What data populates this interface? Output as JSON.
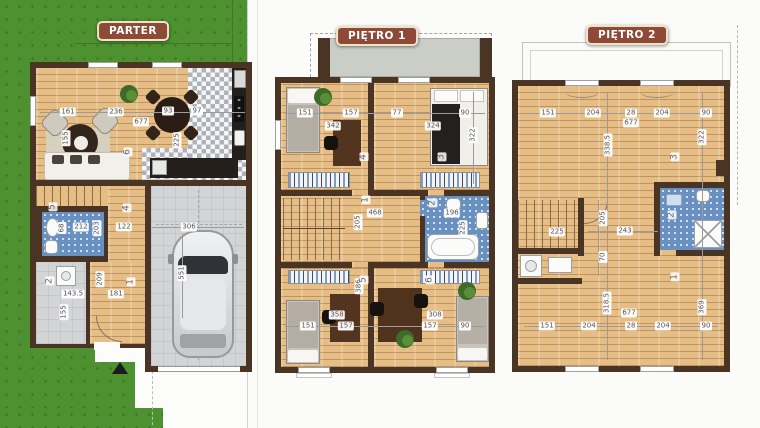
{
  "title": "Floor plans - PARTER / PIĘTRO 1 / PIĘTRO 2",
  "colors": {
    "badge_bg": "#8e4a36",
    "badge_border": "#efe3c6",
    "wall": "#4a3424",
    "wood": "#e5bd85",
    "bath_tile": "#6890c1",
    "garage_grey": "#d3d4d6",
    "lawn_green": "#4e9130",
    "terrace_grey": "#cbcdc7"
  },
  "plans": {
    "parter": {
      "label": "PARTER",
      "labels": [
        {
          "t": "161",
          "x": 68,
          "y": 112
        },
        {
          "t": "236",
          "x": 116,
          "y": 112
        },
        {
          "t": "93",
          "x": 168,
          "y": 111
        },
        {
          "t": "97",
          "x": 197,
          "y": 111
        },
        {
          "t": "677",
          "x": 141,
          "y": 122
        },
        {
          "t": "155",
          "x": 66,
          "y": 138,
          "v": true
        },
        {
          "t": "225",
          "x": 177,
          "y": 140,
          "v": true
        },
        {
          "t": "6",
          "x": 128,
          "y": 152,
          "v": true,
          "room": true
        },
        {
          "t": "4",
          "x": 127,
          "y": 208,
          "v": true,
          "room": true
        },
        {
          "t": "5",
          "x": 53,
          "y": 207,
          "v": true,
          "room": true
        },
        {
          "t": "68",
          "x": 62,
          "y": 228,
          "v": true
        },
        {
          "t": "212",
          "x": 81,
          "y": 227
        },
        {
          "t": "203",
          "x": 97,
          "y": 228,
          "v": true
        },
        {
          "t": "122",
          "x": 124,
          "y": 227
        },
        {
          "t": "2",
          "x": 50,
          "y": 281,
          "v": true,
          "room": true
        },
        {
          "t": "143.5",
          "x": 73,
          "y": 294
        },
        {
          "t": "155",
          "x": 64,
          "y": 312,
          "v": true
        },
        {
          "t": "209",
          "x": 100,
          "y": 279,
          "v": true
        },
        {
          "t": "181",
          "x": 116,
          "y": 294
        },
        {
          "t": "1",
          "x": 131,
          "y": 282,
          "v": true,
          "room": true
        },
        {
          "t": "306",
          "x": 189,
          "y": 227
        },
        {
          "t": "551",
          "x": 182,
          "y": 273,
          "v": true
        }
      ]
    },
    "pietro1": {
      "label": "PIĘTRO 1",
      "labels": [
        {
          "t": "151",
          "x": 305,
          "y": 113
        },
        {
          "t": "157",
          "x": 351,
          "y": 113
        },
        {
          "t": "342",
          "x": 333,
          "y": 126
        },
        {
          "t": "77",
          "x": 397,
          "y": 113
        },
        {
          "t": "90",
          "x": 465,
          "y": 113
        },
        {
          "t": "324",
          "x": 433,
          "y": 126
        },
        {
          "t": "322",
          "x": 473,
          "y": 135,
          "v": true
        },
        {
          "t": "4",
          "x": 364,
          "y": 157,
          "v": true,
          "room": true
        },
        {
          "t": "3",
          "x": 442,
          "y": 157,
          "v": true,
          "room": true
        },
        {
          "t": "468",
          "x": 375,
          "y": 213
        },
        {
          "t": "205",
          "x": 358,
          "y": 222,
          "v": true
        },
        {
          "t": "1",
          "x": 366,
          "y": 200,
          "v": true,
          "room": true
        },
        {
          "t": "2",
          "x": 433,
          "y": 203,
          "v": true,
          "room": true
        },
        {
          "t": "196",
          "x": 452,
          "y": 213
        },
        {
          "t": "225",
          "x": 463,
          "y": 228,
          "v": true
        },
        {
          "t": "386",
          "x": 359,
          "y": 286,
          "v": true
        },
        {
          "t": "5",
          "x": 364,
          "y": 280,
          "v": true,
          "room": true
        },
        {
          "t": "6",
          "x": 430,
          "y": 280,
          "v": true,
          "room": true
        },
        {
          "t": "358",
          "x": 337,
          "y": 315
        },
        {
          "t": "308",
          "x": 435,
          "y": 315
        },
        {
          "t": "151",
          "x": 308,
          "y": 326
        },
        {
          "t": "157",
          "x": 346,
          "y": 326
        },
        {
          "t": "157",
          "x": 430,
          "y": 326
        },
        {
          "t": "90",
          "x": 465,
          "y": 326
        }
      ]
    },
    "pietro2": {
      "label": "PIĘTRO 2",
      "labels": [
        {
          "t": "151",
          "x": 548,
          "y": 113
        },
        {
          "t": "204",
          "x": 593,
          "y": 113
        },
        {
          "t": "28",
          "x": 631,
          "y": 113
        },
        {
          "t": "204",
          "x": 662,
          "y": 113
        },
        {
          "t": "90",
          "x": 706,
          "y": 113
        },
        {
          "t": "677",
          "x": 631,
          "y": 123
        },
        {
          "t": "338.5",
          "x": 608,
          "y": 145,
          "v": true
        },
        {
          "t": "322",
          "x": 702,
          "y": 137,
          "v": true
        },
        {
          "t": "3",
          "x": 675,
          "y": 157,
          "v": true,
          "room": true
        },
        {
          "t": "225",
          "x": 557,
          "y": 232
        },
        {
          "t": "243",
          "x": 625,
          "y": 231
        },
        {
          "t": "205",
          "x": 603,
          "y": 218,
          "v": true
        },
        {
          "t": "70",
          "x": 603,
          "y": 257,
          "v": true
        },
        {
          "t": "2",
          "x": 672,
          "y": 215,
          "v": true,
          "room": true
        },
        {
          "t": "1",
          "x": 675,
          "y": 277,
          "v": true,
          "room": true
        },
        {
          "t": "318.5",
          "x": 607,
          "y": 303,
          "v": true
        },
        {
          "t": "369",
          "x": 702,
          "y": 307,
          "v": true
        },
        {
          "t": "151",
          "x": 547,
          "y": 326
        },
        {
          "t": "204",
          "x": 589,
          "y": 326
        },
        {
          "t": "28",
          "x": 631,
          "y": 326
        },
        {
          "t": "204",
          "x": 663,
          "y": 326
        },
        {
          "t": "90",
          "x": 706,
          "y": 326
        },
        {
          "t": "677",
          "x": 629,
          "y": 313
        }
      ]
    }
  }
}
